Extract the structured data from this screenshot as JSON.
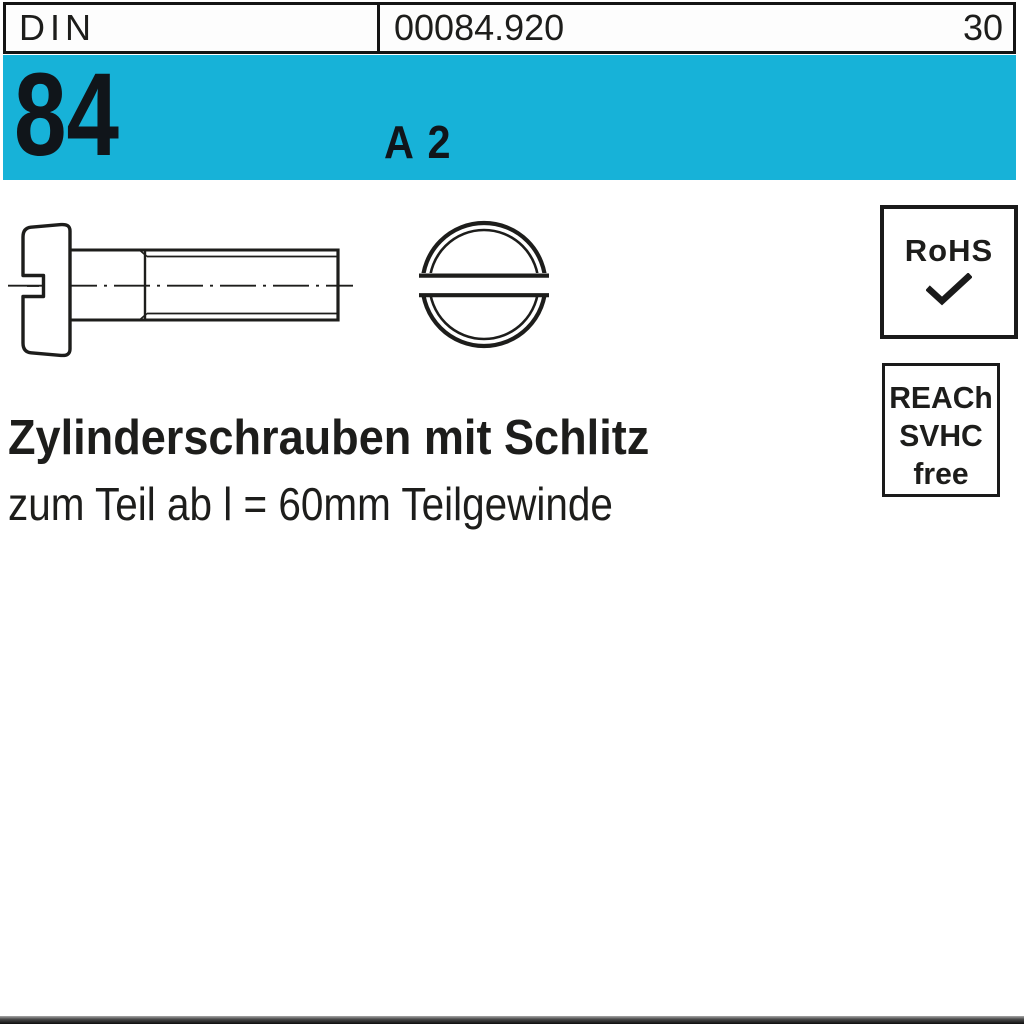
{
  "header": {
    "standard": "DIN",
    "article_number": "00084.920",
    "pack_quantity": "30"
  },
  "banner": {
    "din_number": "84",
    "material": "A 2",
    "background_color": "#17b2d8"
  },
  "badges": {
    "rohs": {
      "label": "RoHS",
      "icon": "checkmark-icon"
    },
    "reach": {
      "line1": "REACh",
      "line2": "SVHC",
      "line3": "free"
    }
  },
  "description": {
    "title": "Zylinderschrauben mit Schlitz",
    "subtitle": "zum Teil ab l = 60mm Teilgewinde"
  },
  "drawing": {
    "side_view": "slotted-cheese-head-screw-side-view",
    "top_view": "slotted-screw-head-top-view",
    "line_color": "#1d1d1b"
  }
}
